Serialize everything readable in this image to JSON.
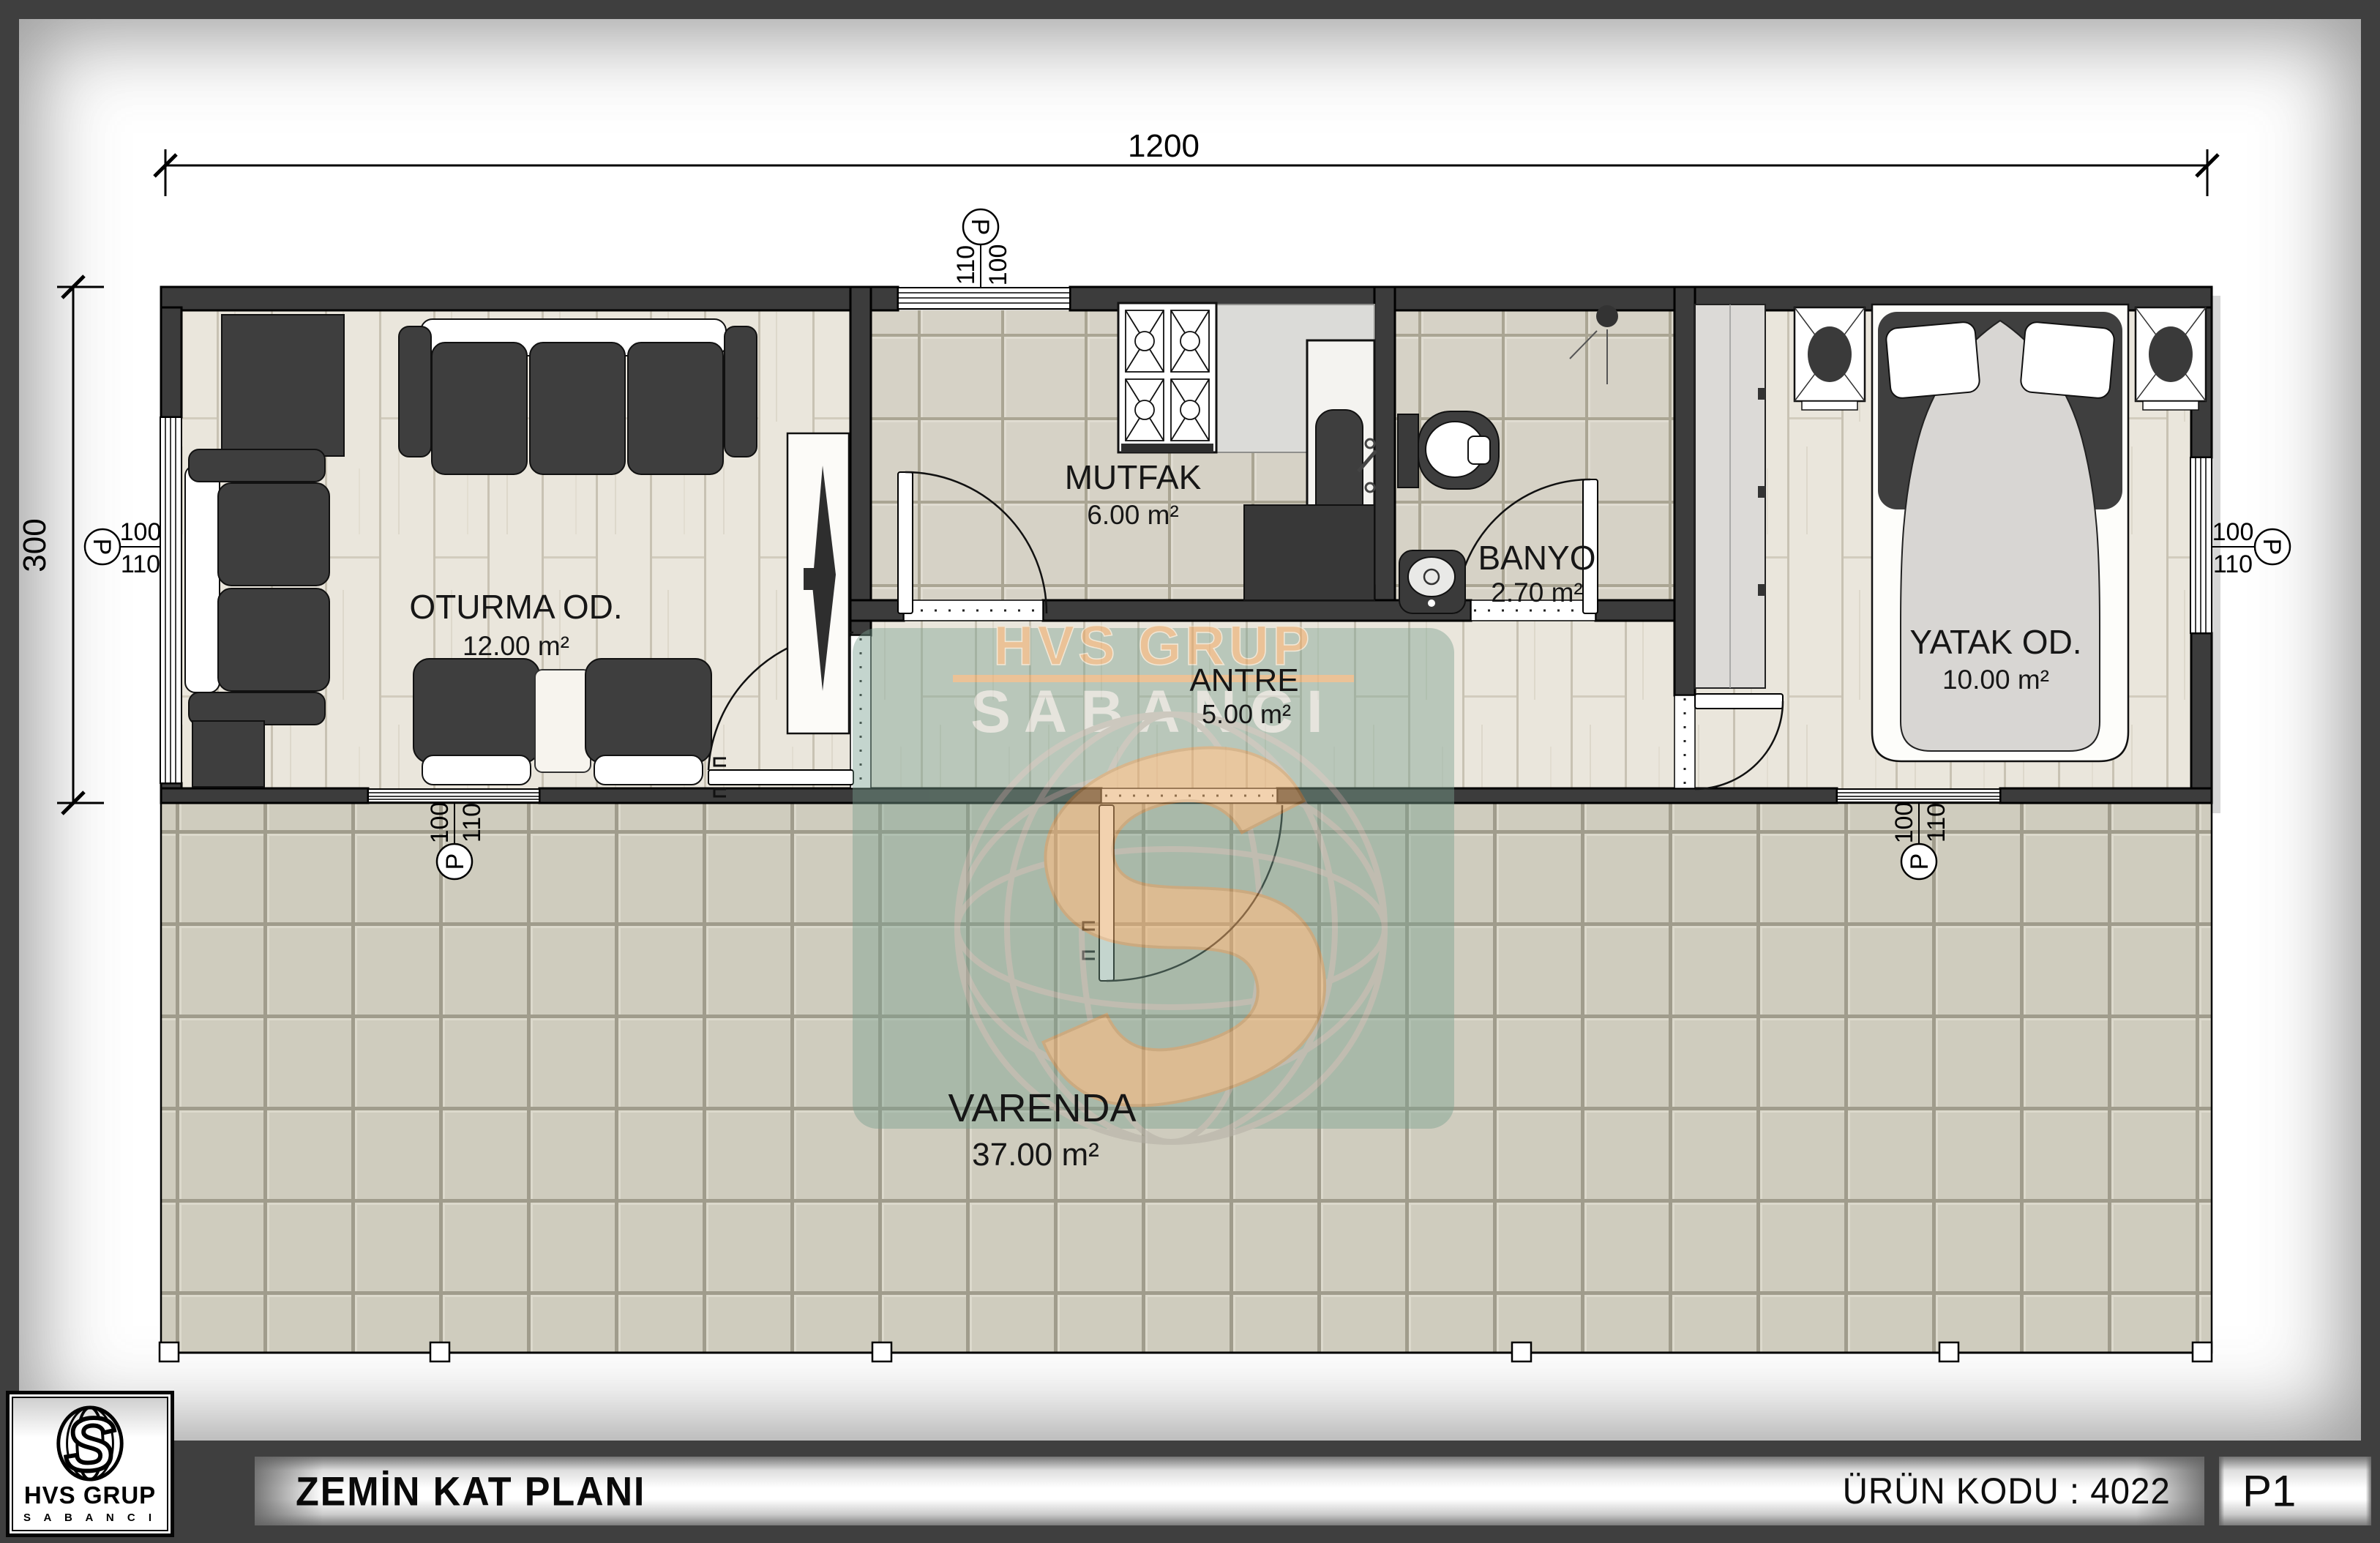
{
  "sheet": {
    "dimensions": {
      "width_label": "1200",
      "height_label": "300"
    },
    "rooms": [
      {
        "id": "oturma",
        "name": "OTURMA OD.",
        "area": "12.00 m²"
      },
      {
        "id": "mutfak",
        "name": "MUTFAK",
        "area": "6.00 m²"
      },
      {
        "id": "banyo",
        "name": "BANYO",
        "area": "2.70 m²"
      },
      {
        "id": "antre",
        "name": "ANTRE",
        "area": "5.00 m²"
      },
      {
        "id": "yatak",
        "name": "YATAK OD.",
        "area": "10.00 m²"
      },
      {
        "id": "varenda",
        "name": "VARENDA",
        "area": "37.00 m²"
      }
    ],
    "window_markers": {
      "letter": "P",
      "top_value": "100",
      "bottom_value": "110"
    }
  },
  "watermark": {
    "line1": "HVS GRUP",
    "line2": "SABANCI",
    "monogram": "S"
  },
  "footer": {
    "logo_title": "HVS GRUP",
    "logo_subtitle": "S A B A N C I",
    "plan_title": "ZEMİN KAT PLANI",
    "product_code": "ÜRÜN KODU : 4022",
    "page_code": "P1"
  },
  "colors": {
    "frame": "#3f3f3f",
    "wall": "#3c3c3c",
    "wood_floor": "#eae6dc",
    "tile_floor": "#d6d2c6",
    "veranda_tile": "#cfccbe",
    "watermark_teal": "#79a08f",
    "watermark_orange": "#eca55f"
  }
}
